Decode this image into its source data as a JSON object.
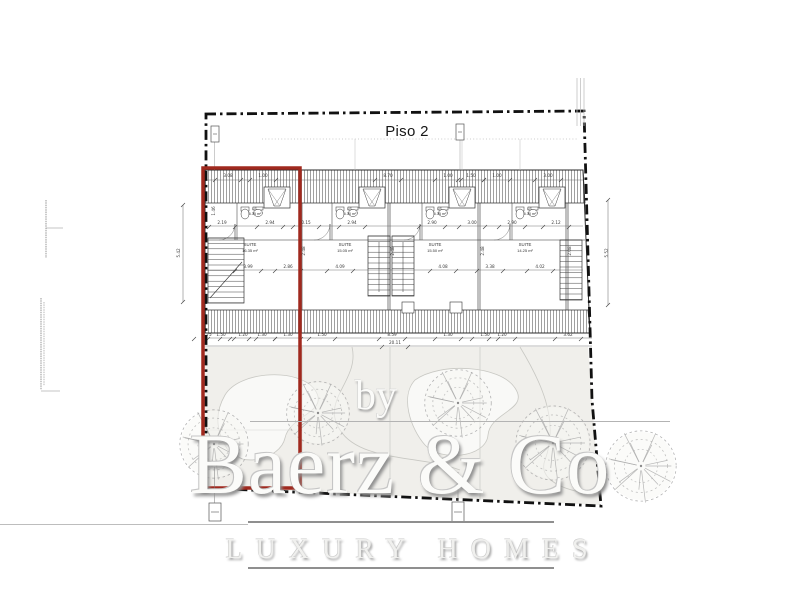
{
  "title": "Piso 2",
  "watermark": {
    "prefix": "by",
    "brand": "Baerz & Co",
    "tagline": "LUXURY HOMES"
  },
  "colors": {
    "highlight": "#a0291e",
    "boundary": "#111111",
    "garden": "#f0efeb",
    "hatch": "#6e6e6e",
    "wall": "#2b2b2b",
    "dim": "#3a3a3a",
    "tree": "#a6a6a6",
    "rule_gray": "#8f8f8f"
  },
  "rooms": {
    "suites": [
      {
        "label": "SUITE",
        "area": "16.35 m²"
      },
      {
        "label": "SUITE",
        "area": "15.05 m²"
      },
      {
        "label": "SUITE",
        "area": "15.50 m²"
      },
      {
        "label": "SUITE",
        "area": "14.25 m²"
      }
    ],
    "baths": [
      {
        "label": "I.S.",
        "area": "5.35 m²"
      },
      {
        "label": "I.S.",
        "area": "5.30 m²"
      },
      {
        "label": "I.S.",
        "area": "5.35 m²"
      },
      {
        "label": "I.S.",
        "area": "5.30 m²"
      }
    ]
  },
  "dimensions": {
    "rows": [
      {
        "y": 177,
        "items": [
          [
            "3.08",
            228
          ],
          [
            "1.00",
            263
          ],
          [
            "8.70",
            388
          ],
          [
            "1.00",
            448
          ],
          [
            "1.50",
            471
          ],
          [
            "1.00",
            497
          ],
          [
            "3.00",
            548
          ]
        ]
      },
      {
        "y": 224,
        "items": [
          [
            "2.19",
            222
          ],
          [
            "2.94",
            270
          ],
          [
            "0.15",
            306
          ],
          [
            "2.94",
            352
          ],
          [
            "2.90",
            432
          ],
          [
            "3.00",
            472
          ],
          [
            "2.90",
            512
          ],
          [
            "2.12",
            556
          ]
        ]
      },
      {
        "y": 268,
        "items": [
          [
            "3.99",
            248
          ],
          [
            "2.86",
            288
          ],
          [
            "4.09",
            340
          ],
          [
            "4.08",
            443
          ],
          [
            "3.38",
            490
          ],
          [
            "4.02",
            540
          ]
        ]
      },
      {
        "y": 336,
        "items": [
          [
            "0.75",
            207
          ],
          [
            "1.50",
            221
          ],
          [
            "1.20",
            243
          ],
          [
            "1.30",
            262
          ],
          [
            "1.30",
            288
          ],
          [
            "1.50",
            322
          ],
          [
            "8.59",
            392
          ],
          [
            "1.30",
            448
          ],
          [
            "1.50",
            485
          ],
          [
            "1.20",
            502
          ],
          [
            "3.62",
            568
          ]
        ]
      },
      {
        "y": 344,
        "items": [
          [
            "20.11",
            395
          ]
        ]
      }
    ],
    "vertical": [
      [
        "5.42",
        180,
        253
      ],
      [
        "5.52",
        608,
        253
      ],
      [
        "1.46",
        215,
        211
      ],
      [
        "2.48",
        305,
        251
      ],
      [
        "2.48",
        394,
        251
      ],
      [
        "2.48",
        484,
        251
      ],
      [
        "2.08",
        571,
        251
      ]
    ]
  },
  "trees": [
    {
      "x": 214,
      "y": 444,
      "r": 36
    },
    {
      "x": 318,
      "y": 413,
      "r": 33
    },
    {
      "x": 458,
      "y": 403,
      "r": 35
    },
    {
      "x": 553,
      "y": 443,
      "r": 39
    },
    {
      "x": 641,
      "y": 466,
      "r": 37
    }
  ]
}
